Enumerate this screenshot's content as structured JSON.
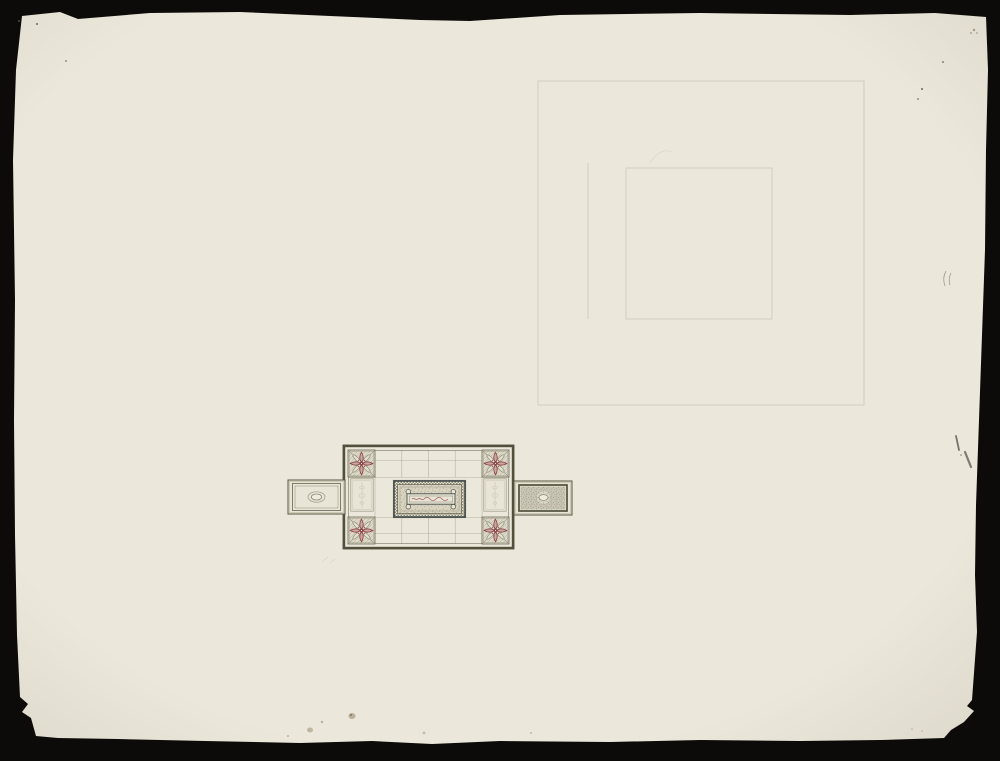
{
  "scene": {
    "description": "Scanned design drawing for a coffered ceiling on cream deckle-edged paper, photographed on a black background; small ornamental plan at centre-left-bottom, faint pencil construction rectangles at upper right; no text visible",
    "visible_text": "",
    "ornament": {
      "corner_rosettes": 4,
      "side_wings": 2,
      "center_corner_rings": 4,
      "center_cartouches": 1
    },
    "pencil_sketch": {
      "outer_rectangles": 1,
      "inner_rectangles": 1,
      "extra_lines": 1
    }
  },
  "colors": {
    "bg": "#0c0b09",
    "paper": "#ebe7da",
    "pencil": "#c1bba7",
    "oliveDark": "#50503c",
    "oliveMid": "#8c8874",
    "speckBase": "#d8d3c0",
    "speckDot": "#97916f",
    "wingDark": "#c9c5b4",
    "wingDot": "#7f7b68",
    "cream": "#e9e5d6",
    "rosetteBase": "#ddd9c8",
    "rosetteHatch": "#b5b09c",
    "slate": "#474f4c",
    "red": "#8a3e41",
    "redFill": "#c9a6a4",
    "redLight": "#a2605f",
    "stain": "#8a7a5e",
    "ink": "#60605a"
  }
}
